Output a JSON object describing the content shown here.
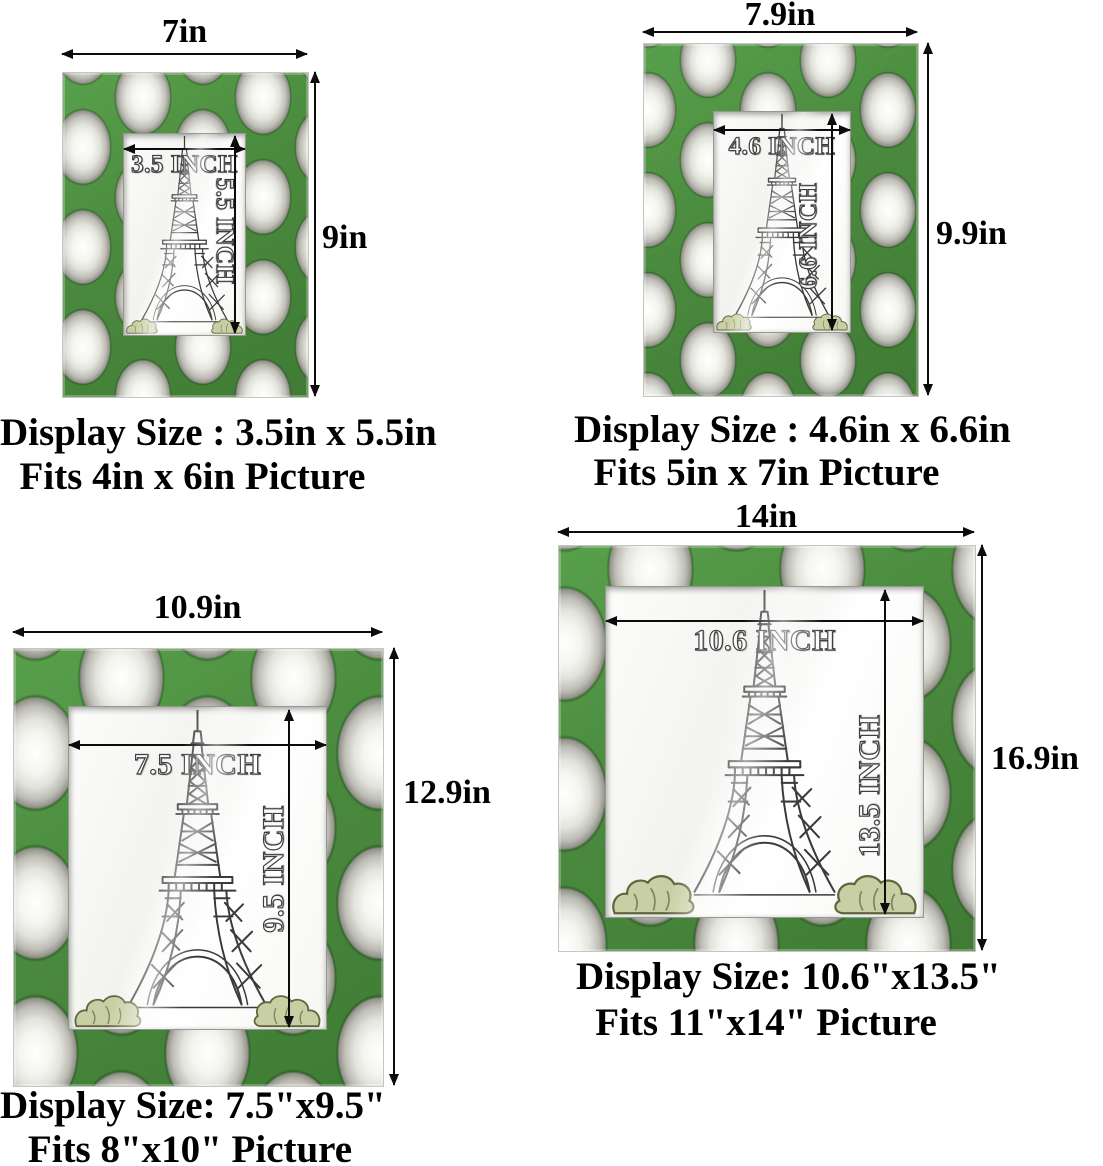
{
  "colors": {
    "background": "#ffffff",
    "grass_green": "#4c8d40",
    "ball_white": "#f4f4f0",
    "ball_shadow": "#93938c",
    "dimension_line": "#0c0c0c",
    "text": "#000000",
    "bush_green": "#c9cfa4"
  },
  "artwork": {
    "subject": "eiffel-tower-sketch"
  },
  "frames": [
    {
      "name": "frame-4x6",
      "outer_width_label": "7in",
      "outer_height_label": "9in",
      "inner_width_label": "3.5 INCH",
      "inner_height_label": "5.5 INCH",
      "caption_display": "Display Size : 3.5in x 5.5in",
      "caption_fits": "Fits 4in x 6in Picture"
    },
    {
      "name": "frame-5x7",
      "outer_width_label": "7.9in",
      "outer_height_label": "9.9in",
      "inner_width_label": "4.6 INCH",
      "inner_height_label": "6.6 INCH",
      "caption_display": "Display Size : 4.6in x 6.6in",
      "caption_fits": "Fits 5in x 7in Picture"
    },
    {
      "name": "frame-8x10",
      "outer_width_label": "10.9in",
      "outer_height_label": "12.9in",
      "inner_width_label": "7.5 INCH",
      "inner_height_label": "9.5 INCH",
      "caption_display": "Display Size: 7.5\"x9.5\"",
      "caption_fits": "Fits 8\"x10\" Picture"
    },
    {
      "name": "frame-11x14",
      "outer_width_label": "14in",
      "outer_height_label": "16.9in",
      "inner_width_label": "10.6 INCH",
      "inner_height_label": "13.5 INCH",
      "caption_display": "Display Size: 10.6\"x13.5\"",
      "caption_fits": "Fits 11\"x14\" Picture"
    }
  ]
}
